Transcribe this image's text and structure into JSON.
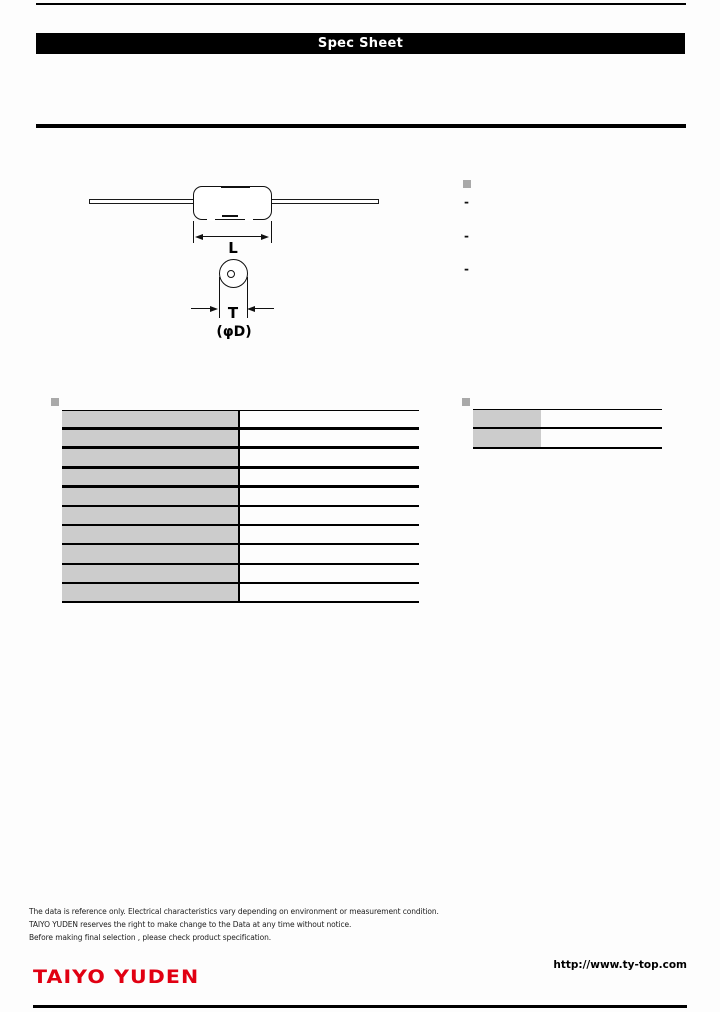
{
  "header": {
    "banner_title": "Spec Sheet"
  },
  "drawing": {
    "labels": {
      "length": "L",
      "thickness": "T",
      "diameter": "(φD)"
    }
  },
  "side_notes": {
    "items": [
      "-",
      "-",
      "-"
    ]
  },
  "spec_table": {
    "rows": [
      {
        "label": "",
        "value": ""
      },
      {
        "label": "",
        "value": ""
      },
      {
        "label": "",
        "value": ""
      },
      {
        "label": "",
        "value": ""
      },
      {
        "label": "",
        "value": ""
      },
      {
        "label": "",
        "value": ""
      },
      {
        "label": "",
        "value": ""
      },
      {
        "label": "",
        "value": ""
      },
      {
        "label": "",
        "value": ""
      },
      {
        "label": "",
        "value": ""
      }
    ]
  },
  "side_table": {
    "rows": [
      {
        "label": "",
        "value": ""
      },
      {
        "label": "",
        "value": ""
      }
    ]
  },
  "footer": {
    "disclaimers": [
      "The data is reference only. Electrical characteristics vary depending on environment or measurement condition.",
      "TAIYO YUDEN reserves the right to make change to the Data at any time without notice.",
      "Before making final selection , please check product specification."
    ],
    "logo_text": "TAIYO YUDEN",
    "website_url": "http://www.ty-top.com"
  },
  "colors": {
    "accent_red": "#e10012",
    "table_label_bg": "#cccccc",
    "bullet_gray": "#a9a9a9",
    "rule_black": "#000000"
  }
}
